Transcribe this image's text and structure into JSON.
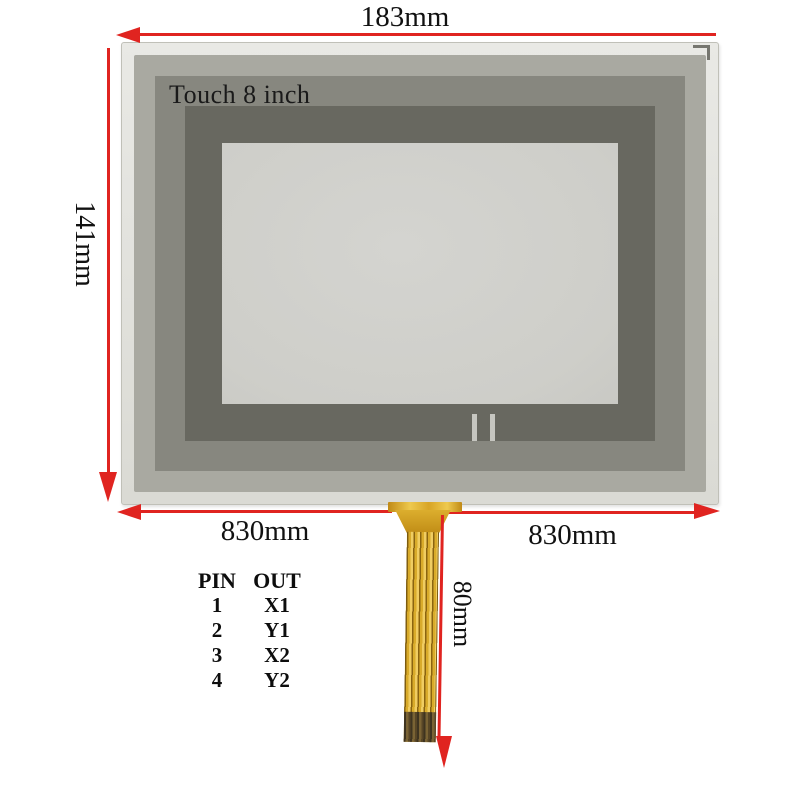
{
  "panel": {
    "label": "Touch 8 inch"
  },
  "dims": {
    "top": "183mm",
    "left": "141mm",
    "bottom_left": "830mm",
    "bottom_right": "830mm",
    "tail": "80mm"
  },
  "pin_table": {
    "header_pin": "PIN",
    "header_out": "OUT",
    "rows": [
      {
        "pin": "1",
        "out": "X1"
      },
      {
        "pin": "2",
        "out": "Y1"
      },
      {
        "pin": "3",
        "out": "X2"
      },
      {
        "pin": "4",
        "out": "Y2"
      }
    ]
  },
  "colors": {
    "dimension_red": "#e02420",
    "cable_gold": "#d9ab2a",
    "cable_contact_dark": "#584626",
    "panel_frame_light": "#e0e0da",
    "panel_frame_mid": "#a9a9a1",
    "panel_frame_olive": "#87877f",
    "panel_frame_dark": "#686860",
    "panel_glass": "#d0d0cc",
    "background": "#ffffff"
  }
}
